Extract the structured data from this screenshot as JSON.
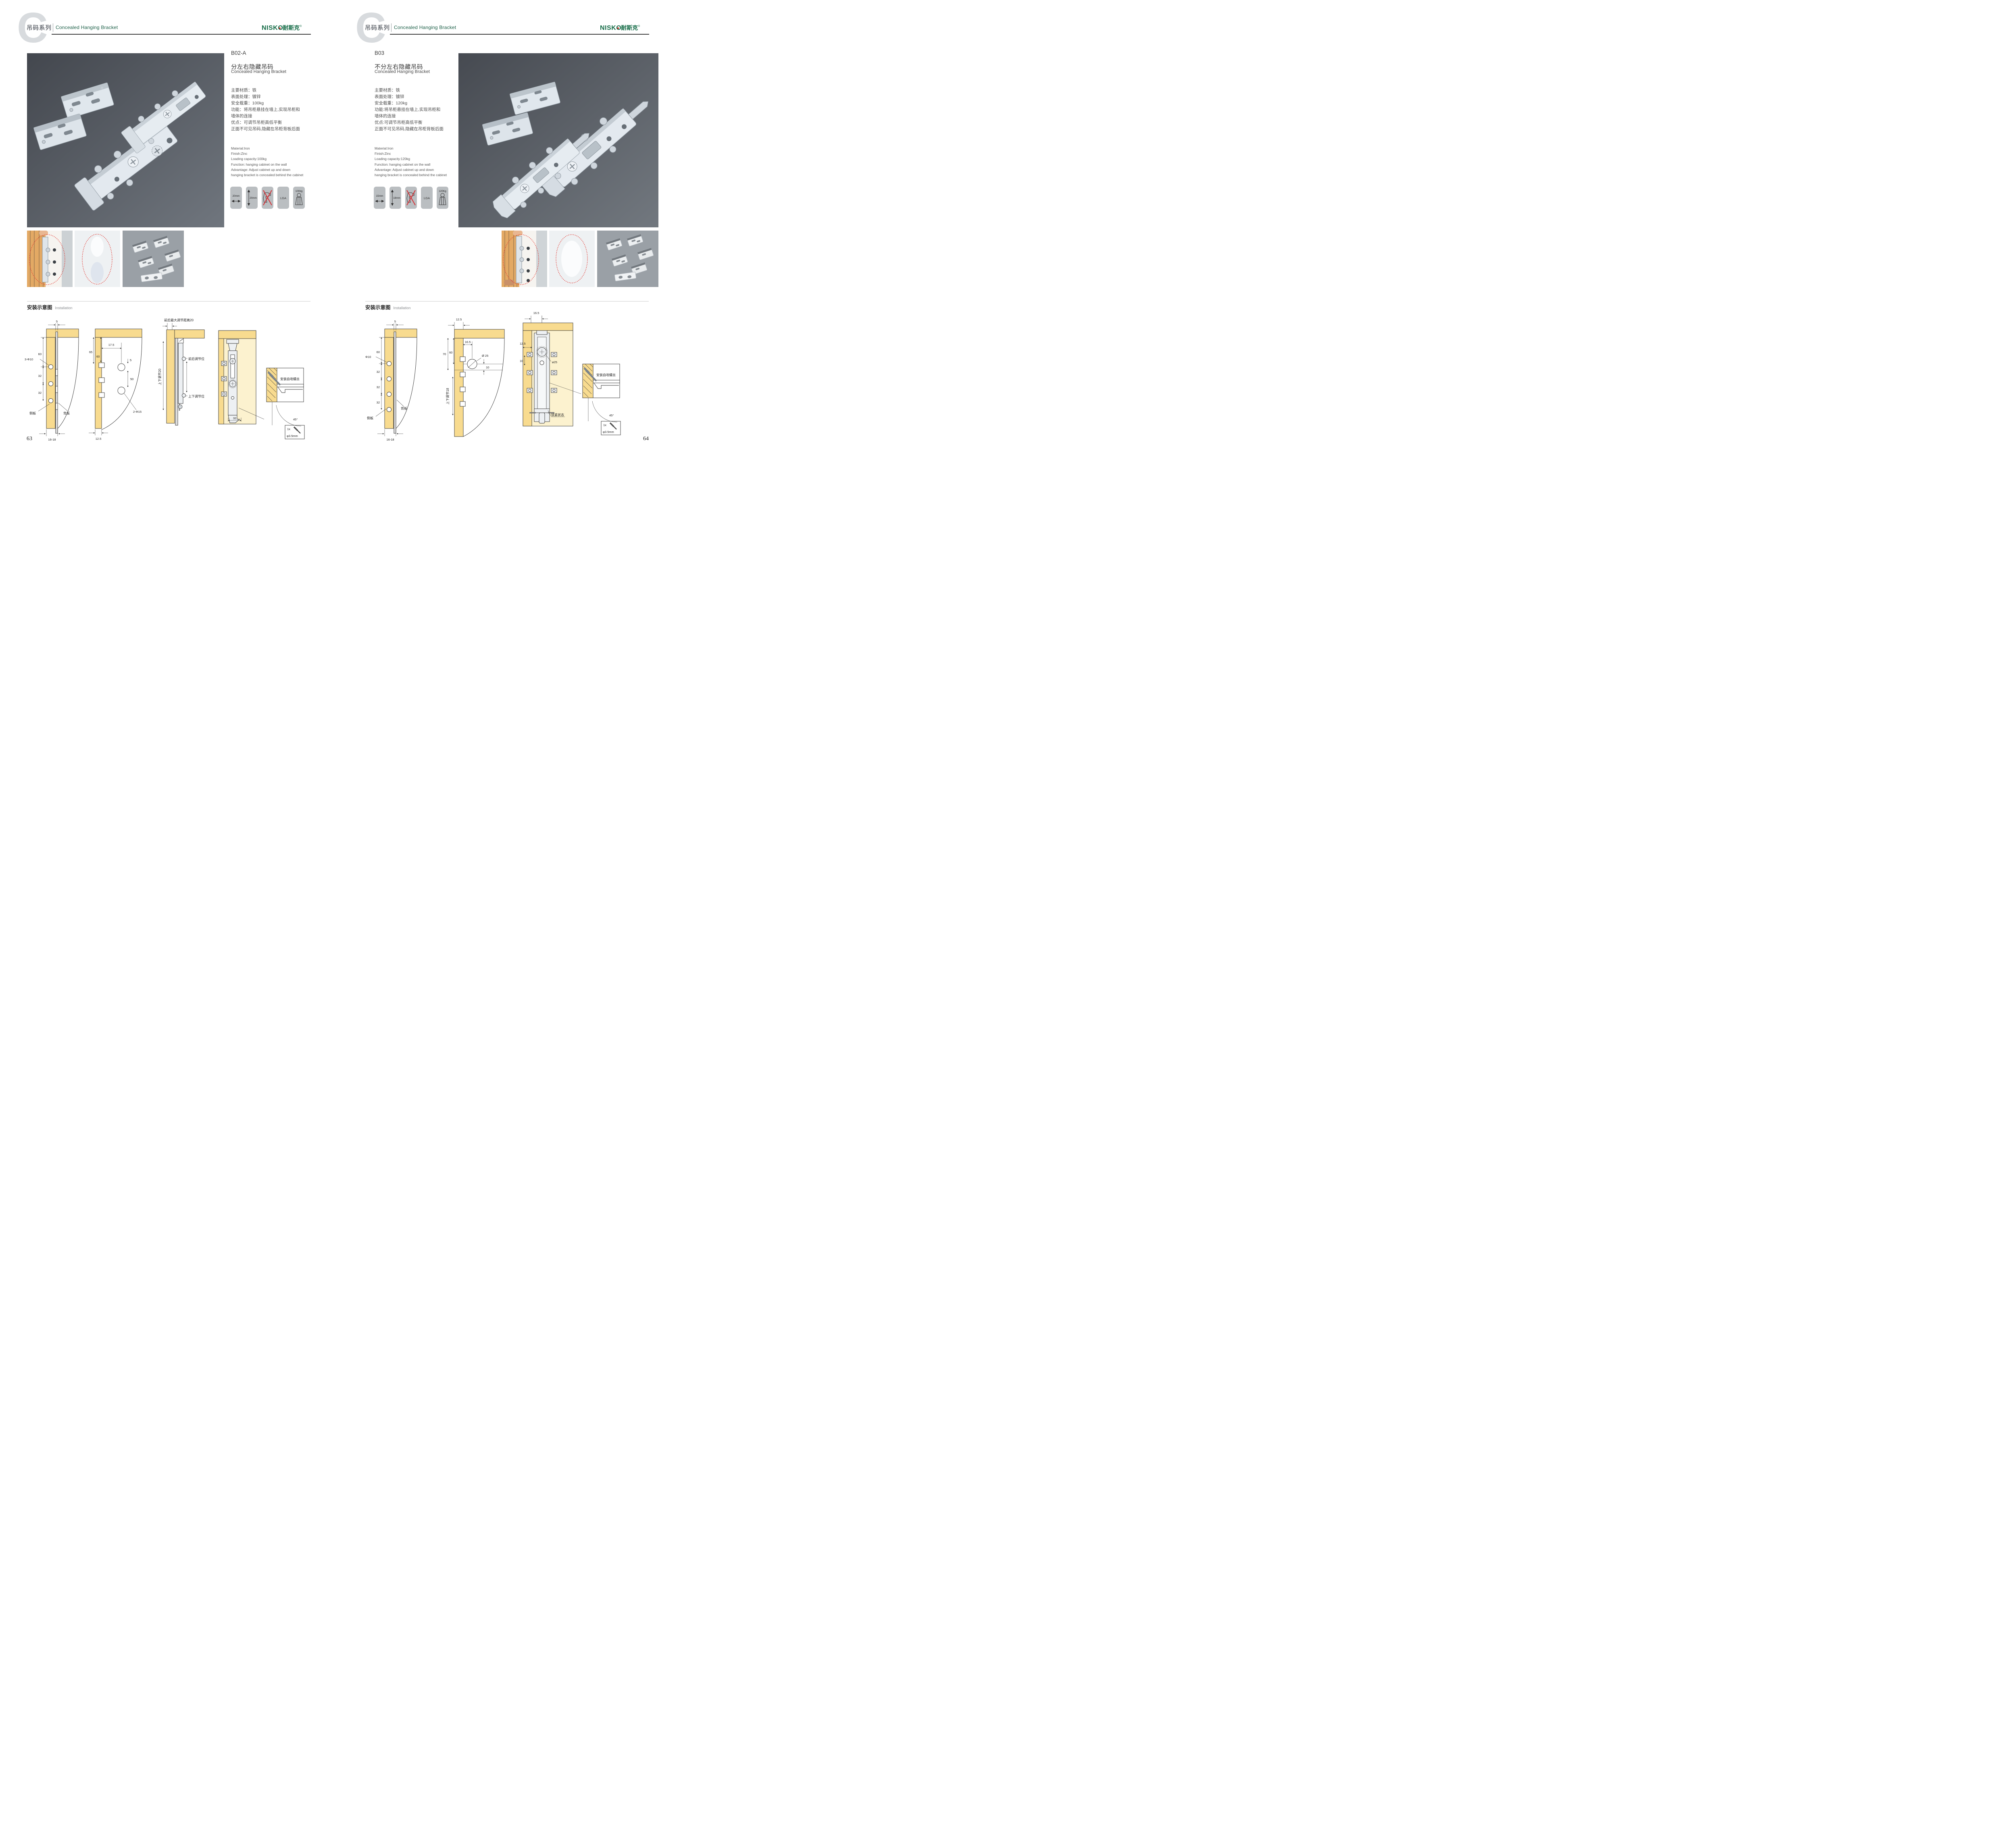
{
  "header": {
    "watermark_letter": "C",
    "series_zh": "吊码系列",
    "series_en": "Concealed Hanging Bracket",
    "brand_en": "NISKO",
    "brand_zh": "耐斯克",
    "brand_reg": "®"
  },
  "install_title": {
    "zh": "安装示意图",
    "en": "Installation"
  },
  "pages": [
    {
      "number": "63",
      "product": {
        "code": "B02-A",
        "title_zh": "分左右隐藏吊码",
        "title_en": "Concealed Hanging Bracket",
        "specs_zh": [
          "主要材质：铁",
          "表面处理：镀锌",
          "安全载重：100kg",
          "功能：将吊柜悬挂在墙上,实现吊柜和",
          "墙体的连接",
          "优点：可调节吊柜高低平衡",
          "正面不可见吊码,隐藏在吊柜背板后面"
        ],
        "specs_en": [
          "Material:Iron",
          "Finish:Zinc",
          "Loading capacity:100kg",
          "Function: hanging cabinet on the wall",
          "Advantage: Adjust cabinet up and down",
          "hanging bracket is concealed behind the cabinet"
        ],
        "icons": [
          {
            "label": "20mm",
            "icon": "width-arrow-icon"
          },
          {
            "label": "20mm",
            "icon": "height-arrow-icon"
          },
          {
            "label": "",
            "icon": "no-drill-icon"
          },
          {
            "label": "LGA",
            "icon": "lga-cert-icon"
          },
          {
            "label": "100kg",
            "icon": "load-weight-icon"
          }
        ]
      },
      "install": {
        "d1": {
          "dim5": "5",
          "dim60": "60",
          "hole": "3-Φ10",
          "dim32a": "32",
          "dim32b": "32",
          "side": "侧板",
          "back": "背板",
          "range": "16-18"
        },
        "d2": {
          "dim175": "17.5",
          "dim65": "65",
          "dim60": "60",
          "dim5": "5",
          "dim50": "50",
          "hole": "2-Φ15",
          "dim125": "12.5"
        },
        "d3": {
          "max": "前后最大调节距离20",
          "vert": "上下调节20",
          "front": "前后调节位",
          "updown": "上下调节位"
        },
        "d4": {
          "dim32": "32"
        },
        "d5": {
          "screw": "安装自攻螺丝",
          "angle": "45°",
          "qty": "1x",
          "dia": "φ3.5mm"
        }
      }
    },
    {
      "number": "64",
      "product": {
        "code": "B03",
        "title_zh": "不分左右隐藏吊码",
        "title_en": "Concealed Hanging Bracket",
        "specs_zh": [
          "主要材质：铁",
          "表面处理：镀锌",
          "安全载重：120kg",
          "功能:将吊柜悬挂在墙上,实现吊柜和",
          "墙体的连接",
          "优点:可调节吊柜高低平衡",
          "正面不可见吊码,隐藏在吊柜背板后面"
        ],
        "specs_en": [
          "Material:Iron",
          "Finish:Zinc",
          "Loading capacity:120kg",
          "Function: hanging cabinet on the wall",
          "Advantage: Adjust cabinet up and down",
          "hanging bracket is concealed behind the cabinet"
        ],
        "icons": [
          {
            "label": "15mm",
            "icon": "width-arrow-icon"
          },
          {
            "label": "18mm",
            "icon": "height-arrow-icon"
          },
          {
            "label": "",
            "icon": "no-drill-icon"
          },
          {
            "label": "LGA",
            "icon": "lga-cert-icon"
          },
          {
            "label": "120Kg",
            "icon": "load-weight-icon"
          }
        ]
      },
      "install": {
        "d1": {
          "dim5": "5",
          "dim60": "60",
          "hole": "Φ10",
          "dim32a": "32",
          "dim32b": "32",
          "dim32c": "32",
          "back": "背板",
          "side": "侧板",
          "range": "16-18"
        },
        "d2": {
          "dim125": "12.5",
          "dim70": "70",
          "dim60": "60",
          "dim165": "16.5",
          "hole": "Ø 25",
          "dim10": "10",
          "vert": "上下调节18"
        },
        "d3": {
          "dim165": "16.5",
          "dim125": "12.5",
          "dim10": "10",
          "hole": "ø25",
          "state": "锁紧状态"
        },
        "d5": {
          "screw": "安装自攻螺丝",
          "angle": "45°",
          "qty": "1x",
          "dia": "φ3.5mm"
        }
      }
    }
  ]
}
